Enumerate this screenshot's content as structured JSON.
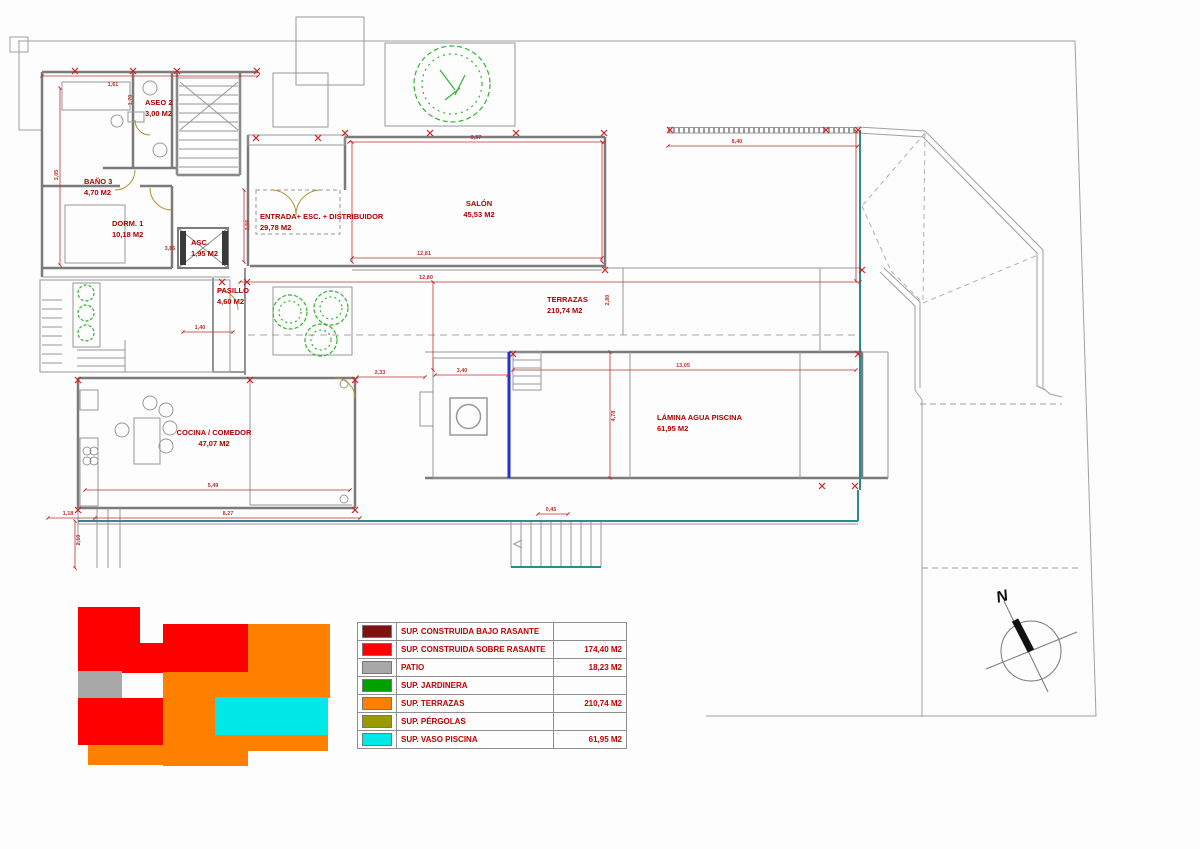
{
  "legend": {
    "rows": [
      {
        "label": "SUP. CONSTRUIDA  BAJO RASANTE",
        "value": "",
        "color": "#7f1111"
      },
      {
        "label": "SUP. CONSTRUIDA SOBRE RASANTE",
        "value": "174,40 M2",
        "color": "#ff0000"
      },
      {
        "label": "PATIO",
        "value": "18,23 M2",
        "color": "#a8a8a8"
      },
      {
        "label": "SUP. JARDINERA",
        "value": "",
        "color": "#00a000"
      },
      {
        "label": "SUP. TERRAZAS",
        "value": "210,74 M2",
        "color": "#ff8000"
      },
      {
        "label": "SUP. PÉRGOLAS",
        "value": "",
        "color": "#999900"
      },
      {
        "label": "SUP. VASO PISCINA",
        "value": "61,95 M2",
        "color": "#00e8e8"
      }
    ]
  },
  "plan": {
    "compass": {
      "label": "N"
    },
    "rooms": [
      {
        "name": "BAÑO 3",
        "area": "4,70 M2",
        "x": 84,
        "y": 176,
        "align": "left"
      },
      {
        "name": "ASEO 2",
        "area": "3,00 M2",
        "x": 145,
        "y": 97,
        "align": "left"
      },
      {
        "name": "DORM. 1",
        "area": "10,18 M2",
        "x": 112,
        "y": 218,
        "align": "left"
      },
      {
        "name": "ASC.",
        "area": "1,95 M2",
        "x": 191,
        "y": 237,
        "align": "left"
      },
      {
        "name": "ENTRADA+ ESC. + DISTRIBUIDOR",
        "area": "29,78 M2",
        "x": 260,
        "y": 211,
        "align": "left"
      },
      {
        "name": "SALÓN",
        "area": "45,53 M2",
        "x": 479,
        "y": 198,
        "align": "center"
      },
      {
        "name": "PASILLO",
        "area": "4,60 M2",
        "x": 217,
        "y": 285,
        "align": "left"
      },
      {
        "name": "TERRAZAS",
        "area": "210,74 M2",
        "x": 547,
        "y": 294,
        "align": "left"
      },
      {
        "name": "LÁMINA AGUA PISCINA",
        "area": "61,95 M2",
        "x": 657,
        "y": 412,
        "align": "left"
      },
      {
        "name": "COCINA / COMEDOR",
        "area": "47,07 M2",
        "x": 214,
        "y": 427,
        "align": "center"
      }
    ],
    "dimensions": [
      {
        "t": "1,61",
        "x": 113,
        "y": 85,
        "rot": 0
      },
      {
        "t": "3,86",
        "x": 170,
        "y": 249,
        "rot": 0
      },
      {
        "t": "9,97",
        "x": 476,
        "y": 138,
        "rot": 0
      },
      {
        "t": "8,40",
        "x": 737,
        "y": 142,
        "rot": 0
      },
      {
        "t": "12,81",
        "x": 424,
        "y": 254,
        "rot": 0
      },
      {
        "t": "12,80",
        "x": 426,
        "y": 278,
        "rot": 0
      },
      {
        "t": "13,05",
        "x": 683,
        "y": 366,
        "rot": 0
      },
      {
        "t": "3,40",
        "x": 462,
        "y": 371,
        "rot": 0
      },
      {
        "t": "1,40",
        "x": 200,
        "y": 328,
        "rot": 0
      },
      {
        "t": "2,33",
        "x": 380,
        "y": 373,
        "rot": 0
      },
      {
        "t": "0,45",
        "x": 551,
        "y": 510,
        "rot": 0
      },
      {
        "t": "5,49",
        "x": 213,
        "y": 486,
        "rot": 0
      },
      {
        "t": "8,27",
        "x": 228,
        "y": 514,
        "rot": 0
      },
      {
        "t": "1,18",
        "x": 68,
        "y": 514,
        "rot": 0
      },
      {
        "t": "3,05",
        "x": 57,
        "y": 175,
        "rot": -90
      },
      {
        "t": "1,70",
        "x": 131,
        "y": 100,
        "rot": -90
      },
      {
        "t": "2,56",
        "x": 248,
        "y": 225,
        "rot": -90
      },
      {
        "t": "2,80",
        "x": 608,
        "y": 300,
        "rot": -90
      },
      {
        "t": "4,78",
        "x": 614,
        "y": 416,
        "rot": -90
      },
      {
        "t": "2,10",
        "x": 79,
        "y": 540,
        "rot": -90
      }
    ]
  }
}
